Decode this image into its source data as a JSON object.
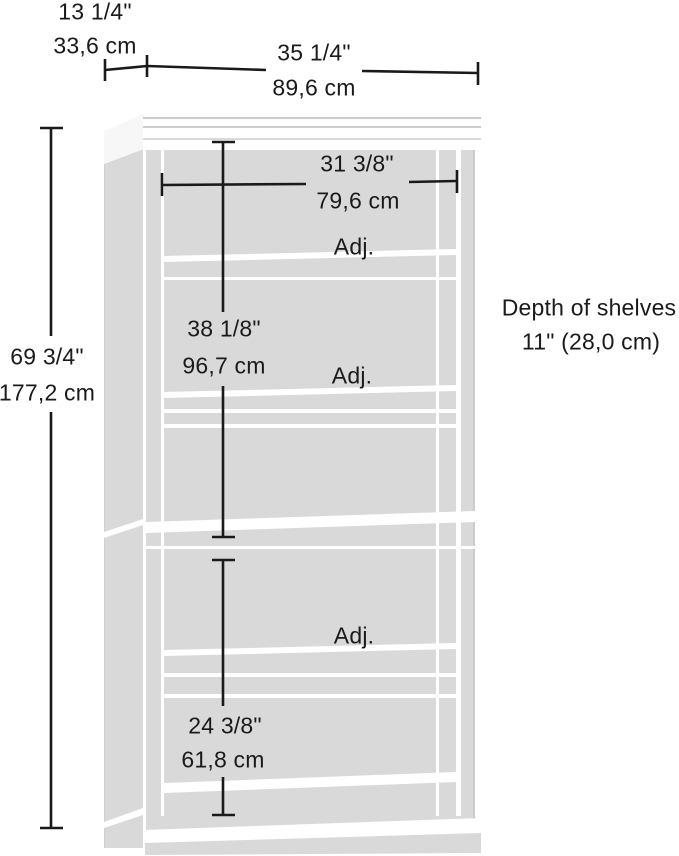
{
  "diagram": {
    "type": "furniture-dimension-drawing",
    "labels": {
      "top_depth_in": "13 1/4\"",
      "top_depth_cm": "33,6 cm",
      "top_width_in": "35 1/4\"",
      "top_width_cm": "89,6 cm",
      "inner_width_in": "31 3/8\"",
      "inner_width_cm": "79,6 cm",
      "upper_section_height_in": "38 1/8\"",
      "upper_section_height_cm": "96,7 cm",
      "total_height_in": "69 3/4\"",
      "total_height_cm": "177,2 cm",
      "lower_section_height_in": "24 3/8\"",
      "lower_section_height_cm": "61,8 cm",
      "adjustable_shelf": "Adj.",
      "depth_note_line1": "Depth of shelves",
      "depth_note_line2": "11\" (28,0 cm)"
    },
    "colors": {
      "dimension_line": "#1a1a1a",
      "panel_gray": "#d9d9d9",
      "gap_white": "#ffffff",
      "edge_gray": "#c9c9c9"
    }
  }
}
